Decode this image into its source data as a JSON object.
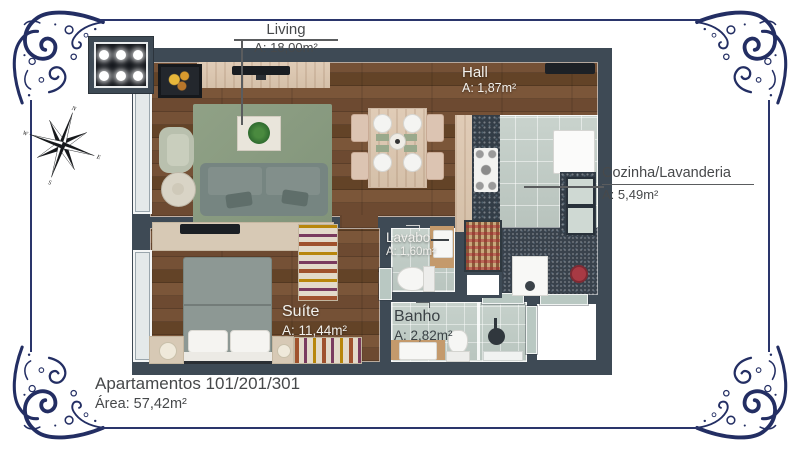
{
  "frame": {
    "ornament_color": "#232e63"
  },
  "compass": {
    "north": "N",
    "east": "E",
    "south": "S",
    "west": "W"
  },
  "rooms": {
    "living": {
      "name": "Living",
      "area": "A: 18,00m²"
    },
    "hall": {
      "name": "Hall",
      "area": "A: 1,87m²"
    },
    "cozinha": {
      "name": "Cozinha/Lavanderia",
      "area": "A: 5,49m²"
    },
    "lavabo": {
      "name": "Lavabo",
      "area": "A: 1,60m²"
    },
    "suite": {
      "name": "Suíte",
      "area": "A: 11,44m²"
    },
    "banho": {
      "name": "Banho",
      "area": "A: 2,82m²"
    }
  },
  "footer": {
    "title": "Apartamentos 101/201/301",
    "area": "Área: 57,42m²"
  },
  "colors": {
    "wall": "#3e4a55",
    "rug": "#8a9b80",
    "wood": "#6d4a31",
    "ornament": "#232e63"
  }
}
